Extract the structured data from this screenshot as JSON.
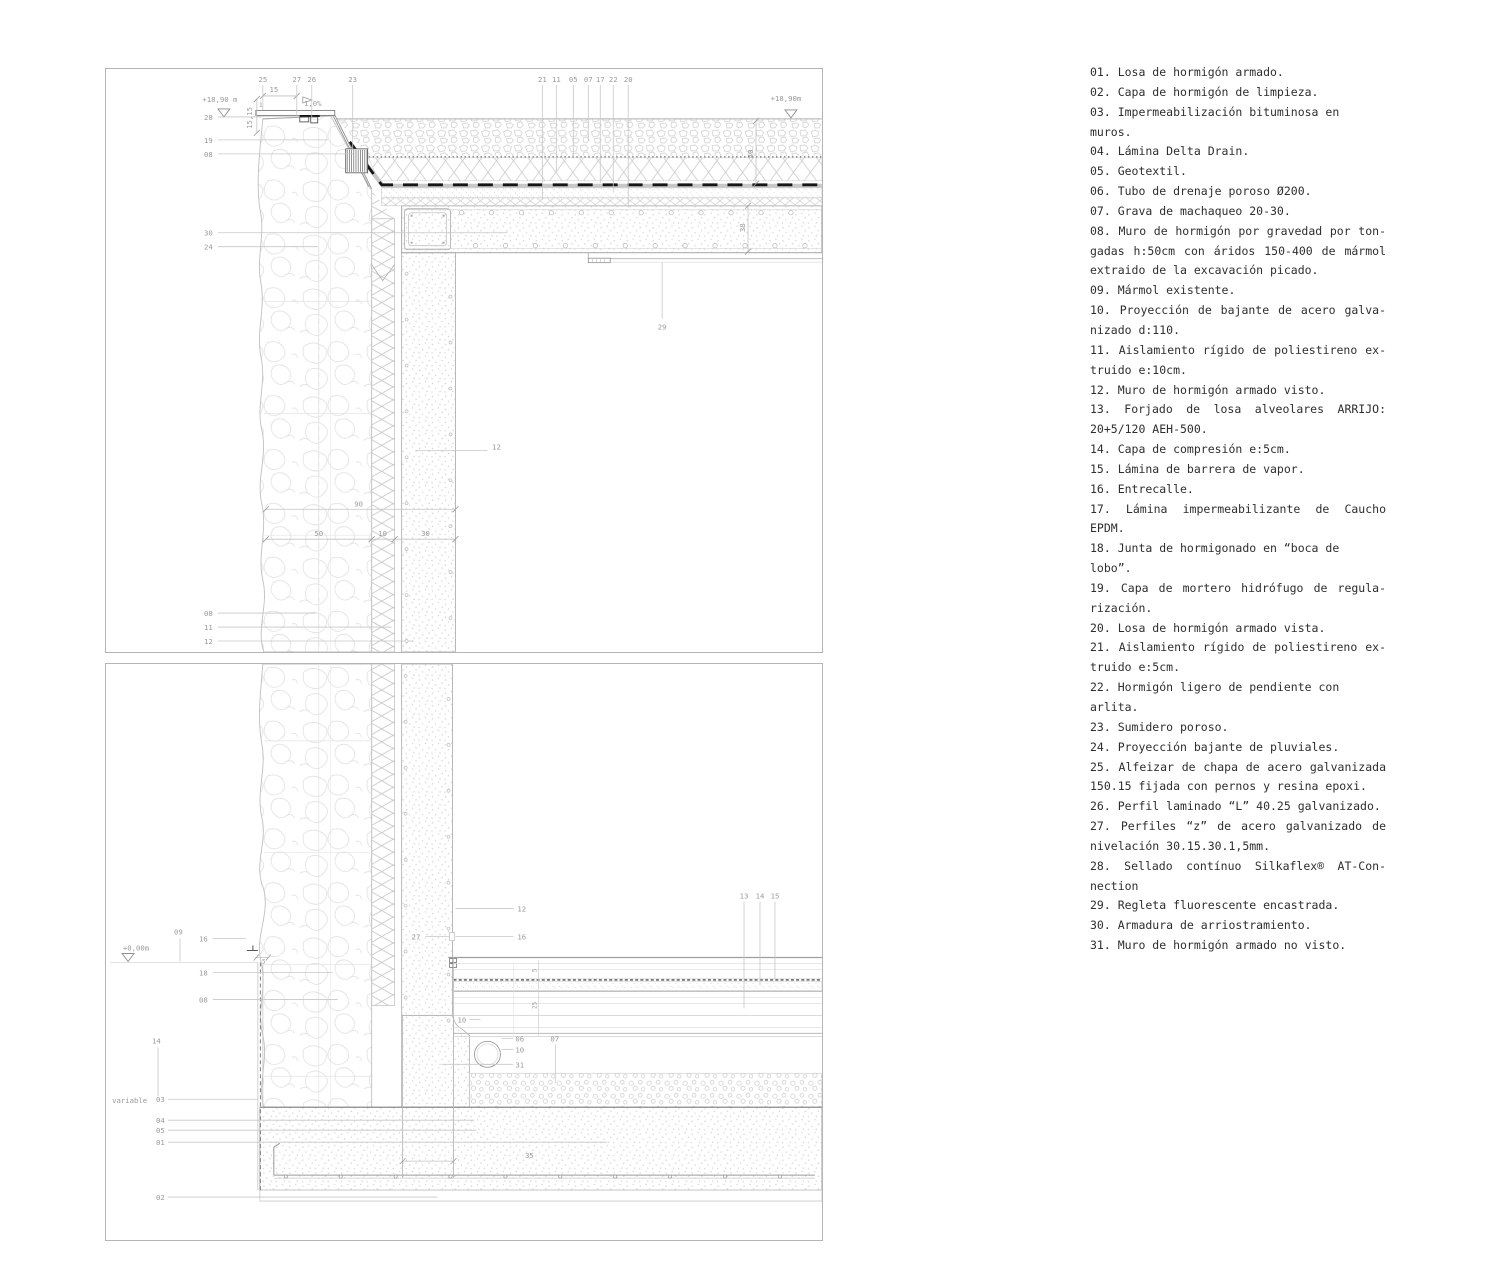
{
  "legend": {
    "items": [
      {
        "lines": [
          "01. Losa de hormigón armado."
        ]
      },
      {
        "lines": [
          "02. Capa de hormigón de limpieza."
        ]
      },
      {
        "lines": [
          "03. Impermeabilización bituminosa en muros."
        ]
      },
      {
        "lines": [
          "04. Lámina Delta Drain."
        ]
      },
      {
        "lines": [
          "05. Geotextil."
        ]
      },
      {
        "lines": [
          "06. Tubo de drenaje poroso Ø200."
        ]
      },
      {
        "lines": [
          "07. Grava de machaqueo 20-30."
        ]
      },
      {
        "lines": [
          "08. Muro de hormigón por gravedad por ton-",
          "gadas h:50cm con áridos 150-400 de mármol",
          "extraido de la excavación picado."
        ]
      },
      {
        "lines": [
          "09. Mármol existente."
        ]
      },
      {
        "lines": [
          "10. Proyección de bajante de acero galva-",
          "nizado d:110."
        ]
      },
      {
        "lines": [
          "11. Aislamiento rígido de poliestireno ex-",
          "truido e:10cm."
        ]
      },
      {
        "lines": [
          "12. Muro de hormigón armado visto."
        ]
      },
      {
        "lines": [
          "13. Forjado de losa alveolares ARRIJO:",
          "20+5/120 AEH-500."
        ]
      },
      {
        "lines": [
          "14. Capa de compresión e:5cm."
        ]
      },
      {
        "lines": [
          "15. Lámina de barrera de vapor."
        ]
      },
      {
        "lines": [
          "16. Entrecalle."
        ]
      },
      {
        "lines": [
          "17. Lámina impermeabilizante de Caucho",
          "EPDM."
        ]
      },
      {
        "lines": [
          "18. Junta de hormigonado en “boca de lobo”."
        ]
      },
      {
        "lines": [
          "19. Capa de mortero hidrófugo de regula-",
          "rización."
        ]
      },
      {
        "lines": [
          "20. Losa de hormigón armado vista."
        ]
      },
      {
        "lines": [
          "21. Aislamiento rígido de poliestireno ex-",
          "truido e:5cm."
        ]
      },
      {
        "lines": [
          "22. Hormigón ligero de pendiente con arlita."
        ]
      },
      {
        "lines": [
          "23. Sumidero poroso."
        ]
      },
      {
        "lines": [
          "24. Proyección bajante de pluviales."
        ]
      },
      {
        "lines": [
          "25. Alfeizar de chapa de acero galvanizada",
          "150.15 fijada con pernos y resina epoxi."
        ]
      },
      {
        "lines": [
          "26. Perfil laminado “L” 40.25 galvanizado."
        ]
      },
      {
        "lines": [
          "27. Perfiles “z” de acero galvanizado de",
          "nivelación 30.15.30.1,5mm."
        ]
      },
      {
        "lines": [
          "28. Sellado contínuo Silkaflex® AT-Con-",
          "nection"
        ]
      },
      {
        "lines": [
          "29. Regleta fluorescente encastrada."
        ]
      },
      {
        "lines": [
          "30. Armadura de arriostramiento."
        ]
      },
      {
        "lines": [
          "31. Muro de hormigón armado no visto."
        ]
      }
    ]
  },
  "drawings": {
    "top": {
      "name": "detalle-peto-cubierta",
      "labels": [
        {
          "t": "+18,90 m",
          "x": 114,
          "y": 33
        },
        {
          "t": "+18,90m",
          "x": 681,
          "y": 32
        },
        {
          "t": "28",
          "x": 98,
          "y": 51,
          "a": "s",
          "l": [
            112,
            48,
            155,
            48
          ]
        },
        {
          "t": "19",
          "x": 98,
          "y": 74,
          "a": "s",
          "l": [
            112,
            71,
            222,
            71
          ]
        },
        {
          "t": "08",
          "x": 98,
          "y": 88,
          "a": "s",
          "l": [
            112,
            85,
            248,
            85
          ]
        },
        {
          "t": "30",
          "x": 98,
          "y": 167,
          "a": "s",
          "l": [
            112,
            164,
            402,
            164
          ]
        },
        {
          "t": "24",
          "x": 98,
          "y": 181,
          "a": "s",
          "l": [
            112,
            178,
            212,
            178
          ]
        },
        {
          "t": "08",
          "x": 98,
          "y": 548,
          "a": "s",
          "l": [
            112,
            545,
            210,
            545
          ]
        },
        {
          "t": "11",
          "x": 98,
          "y": 562,
          "a": "s",
          "l": [
            112,
            559,
            286,
            559
          ]
        },
        {
          "t": "12",
          "x": 98,
          "y": 576,
          "a": "s",
          "l": [
            112,
            573,
            308,
            573
          ]
        },
        {
          "t": "25",
          "x": 157,
          "y": 13,
          "l": [
            157,
            16,
            157,
            41
          ]
        },
        {
          "t": "27",
          "x": 191,
          "y": 13,
          "l": [
            191,
            16,
            191,
            48
          ]
        },
        {
          "t": "26",
          "x": 206,
          "y": 13,
          "l": [
            206,
            16,
            206,
            49
          ]
        },
        {
          "t": "23",
          "x": 247,
          "y": 13,
          "l": [
            247,
            16,
            247,
            80
          ]
        },
        {
          "t": "21",
          "x": 437,
          "y": 13,
          "l": [
            437,
            16,
            437,
            131
          ]
        },
        {
          "t": "11",
          "x": 451,
          "y": 13,
          "l": [
            451,
            16,
            451,
            103
          ]
        },
        {
          "t": "05",
          "x": 468,
          "y": 13,
          "l": [
            468,
            16,
            468,
            88
          ]
        },
        {
          "t": "07",
          "x": 483,
          "y": 13,
          "l": [
            483,
            16,
            483,
            72
          ]
        },
        {
          "t": "17",
          "x": 495,
          "y": 13,
          "l": [
            495,
            16,
            495,
            114
          ]
        },
        {
          "t": "22",
          "x": 508,
          "y": 13,
          "l": [
            508,
            16,
            508,
            123
          ]
        },
        {
          "t": "20",
          "x": 523,
          "y": 13,
          "l": [
            523,
            16,
            523,
            139
          ]
        },
        {
          "t": "15",
          "x": 168,
          "y": 23
        },
        {
          "t": "1",
          "x": 155,
          "y": 38,
          "fs": 6
        },
        {
          "t": "15,15",
          "x": 146,
          "y": 49,
          "r": -90
        },
        {
          "t": "1,0%",
          "x": 207,
          "y": 37
        },
        {
          "t": "29",
          "x": 557,
          "y": 261,
          "l": [
            557,
            250,
            557,
            194
          ]
        },
        {
          "t": "12",
          "x": 391,
          "y": 381,
          "l": [
            310,
            382,
            382,
            382
          ]
        },
        {
          "t": "90",
          "x": 253,
          "y": 438
        },
        {
          "t": "50",
          "x": 213,
          "y": 468
        },
        {
          "t": "10",
          "x": 277,
          "y": 468
        },
        {
          "t": "30",
          "x": 320,
          "y": 468
        },
        {
          "t": "40",
          "x": 648,
          "y": 85,
          "r": -90
        },
        {
          "t": "38",
          "x": 640,
          "y": 159,
          "r": -90
        }
      ]
    },
    "bottom": {
      "name": "detalle-arranque-muro",
      "labels": [
        {
          "t": "+0,00m",
          "x": 30,
          "y": 287
        },
        {
          "t": "09",
          "x": 68,
          "y": 271,
          "a": "s",
          "l": [
            74,
            275,
            74,
            298
          ]
        },
        {
          "t": "16",
          "x": 93,
          "y": 278,
          "a": "s",
          "l": [
            107,
            275,
            140,
            275
          ]
        },
        {
          "t": "18",
          "x": 93,
          "y": 312,
          "a": "s",
          "l": [
            107,
            309,
            227,
            309
          ]
        },
        {
          "t": "08",
          "x": 93,
          "y": 339,
          "a": "s",
          "l": [
            107,
            336,
            232,
            336
          ]
        },
        {
          "t": "14",
          "x": 46,
          "y": 380,
          "a": "s",
          "l": [
            52,
            384,
            52,
            433
          ]
        },
        {
          "t": "variable",
          "x": 6,
          "y": 440,
          "a": "s"
        },
        {
          "t": "03",
          "x": 50,
          "y": 439,
          "a": "s",
          "l": [
            62,
            436,
            152,
            436
          ]
        },
        {
          "t": "04",
          "x": 50,
          "y": 460,
          "a": "s",
          "l": [
            62,
            457,
            369,
            457
          ]
        },
        {
          "t": "05",
          "x": 50,
          "y": 470,
          "a": "s",
          "l": [
            62,
            467,
            371,
            467
          ]
        },
        {
          "t": "01",
          "x": 50,
          "y": 482,
          "a": "s",
          "l": [
            62,
            479,
            502,
            479
          ]
        },
        {
          "t": "02",
          "x": 50,
          "y": 537,
          "a": "s",
          "l": [
            62,
            534,
            332,
            534
          ]
        },
        {
          "t": "12",
          "x": 412,
          "y": 248,
          "a": "s",
          "l": [
            350,
            245,
            408,
            245
          ]
        },
        {
          "t": "16",
          "x": 412,
          "y": 276,
          "a": "s",
          "l": [
            350,
            273,
            408,
            273
          ]
        },
        {
          "t": "27",
          "x": 306,
          "y": 276,
          "a": "s",
          "l": [
            320,
            273,
            344,
            273
          ]
        },
        {
          "t": "5",
          "x": 158,
          "y": 300,
          "fs": 6
        },
        {
          "t": "13",
          "x": 639,
          "y": 235,
          "l": [
            639,
            238,
            639,
            345
          ]
        },
        {
          "t": "14",
          "x": 655,
          "y": 235,
          "l": [
            655,
            238,
            655,
            322
          ]
        },
        {
          "t": "15",
          "x": 670,
          "y": 235,
          "l": [
            670,
            238,
            670,
            316
          ]
        },
        {
          "t": "10",
          "x": 352,
          "y": 359,
          "a": "s",
          "l": [
            364,
            356,
            375,
            356
          ]
        },
        {
          "t": "06",
          "x": 410,
          "y": 378,
          "a": "s",
          "l": [
            396,
            375,
            408,
            375
          ]
        },
        {
          "t": "10",
          "x": 410,
          "y": 389,
          "a": "s",
          "l": [
            396,
            386,
            408,
            386
          ]
        },
        {
          "t": "31",
          "x": 410,
          "y": 404,
          "a": "s",
          "l": [
            336,
            401,
            408,
            401
          ]
        },
        {
          "t": "07",
          "x": 445,
          "y": 378,
          "a": "s",
          "l": [
            450,
            381,
            450,
            420
          ]
        },
        {
          "t": "35",
          "x": 424,
          "y": 495
        },
        {
          "t": "5",
          "x": 431,
          "y": 307,
          "r": -90,
          "fs": 6
        },
        {
          "t": "25",
          "x": 431,
          "y": 342,
          "r": -90,
          "fs": 6
        }
      ]
    }
  }
}
